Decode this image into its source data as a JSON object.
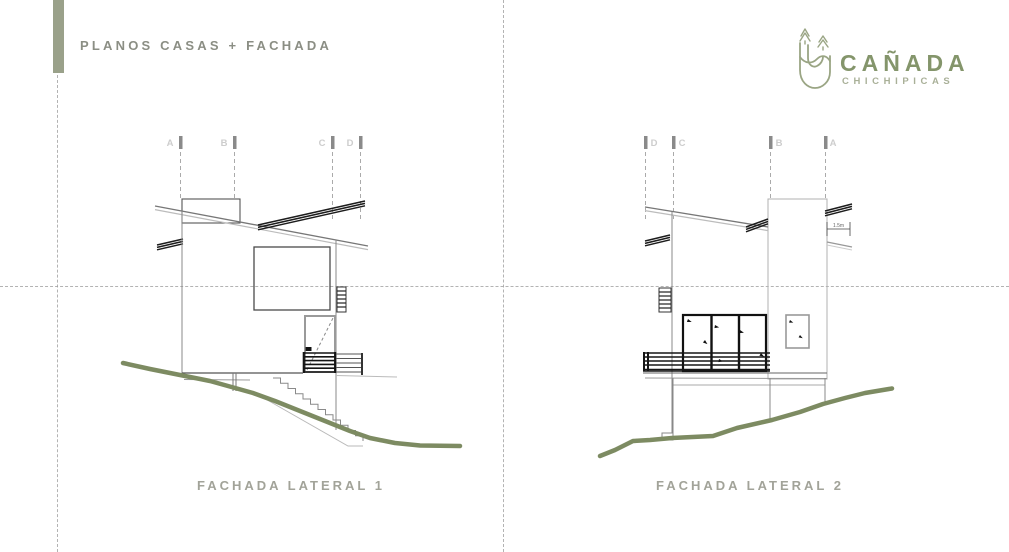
{
  "header": {
    "title": "PLANOS CASAS + FACHADA"
  },
  "logo": {
    "title": "CAÑADA",
    "subtitle": "CHICHIPICAS"
  },
  "drawings": {
    "left": {
      "caption": "FACHADA LATERAL 1",
      "grid_labels": [
        "A",
        "B",
        "C",
        "D"
      ]
    },
    "right": {
      "caption": "FACHADA LATERAL 2",
      "grid_labels": [
        "D",
        "C",
        "B",
        "A"
      ],
      "dimension_label": "1.5m"
    }
  },
  "colors": {
    "accent_bar": "#9aa18a",
    "header_text": "#8b8e84",
    "logo_green": "#84956b",
    "logo_subtitle": "#a9b098",
    "caption": "#a2a399",
    "terrain": "#7d8b62",
    "line_dark": "#1c1c1c",
    "line_gray": "#888888"
  }
}
